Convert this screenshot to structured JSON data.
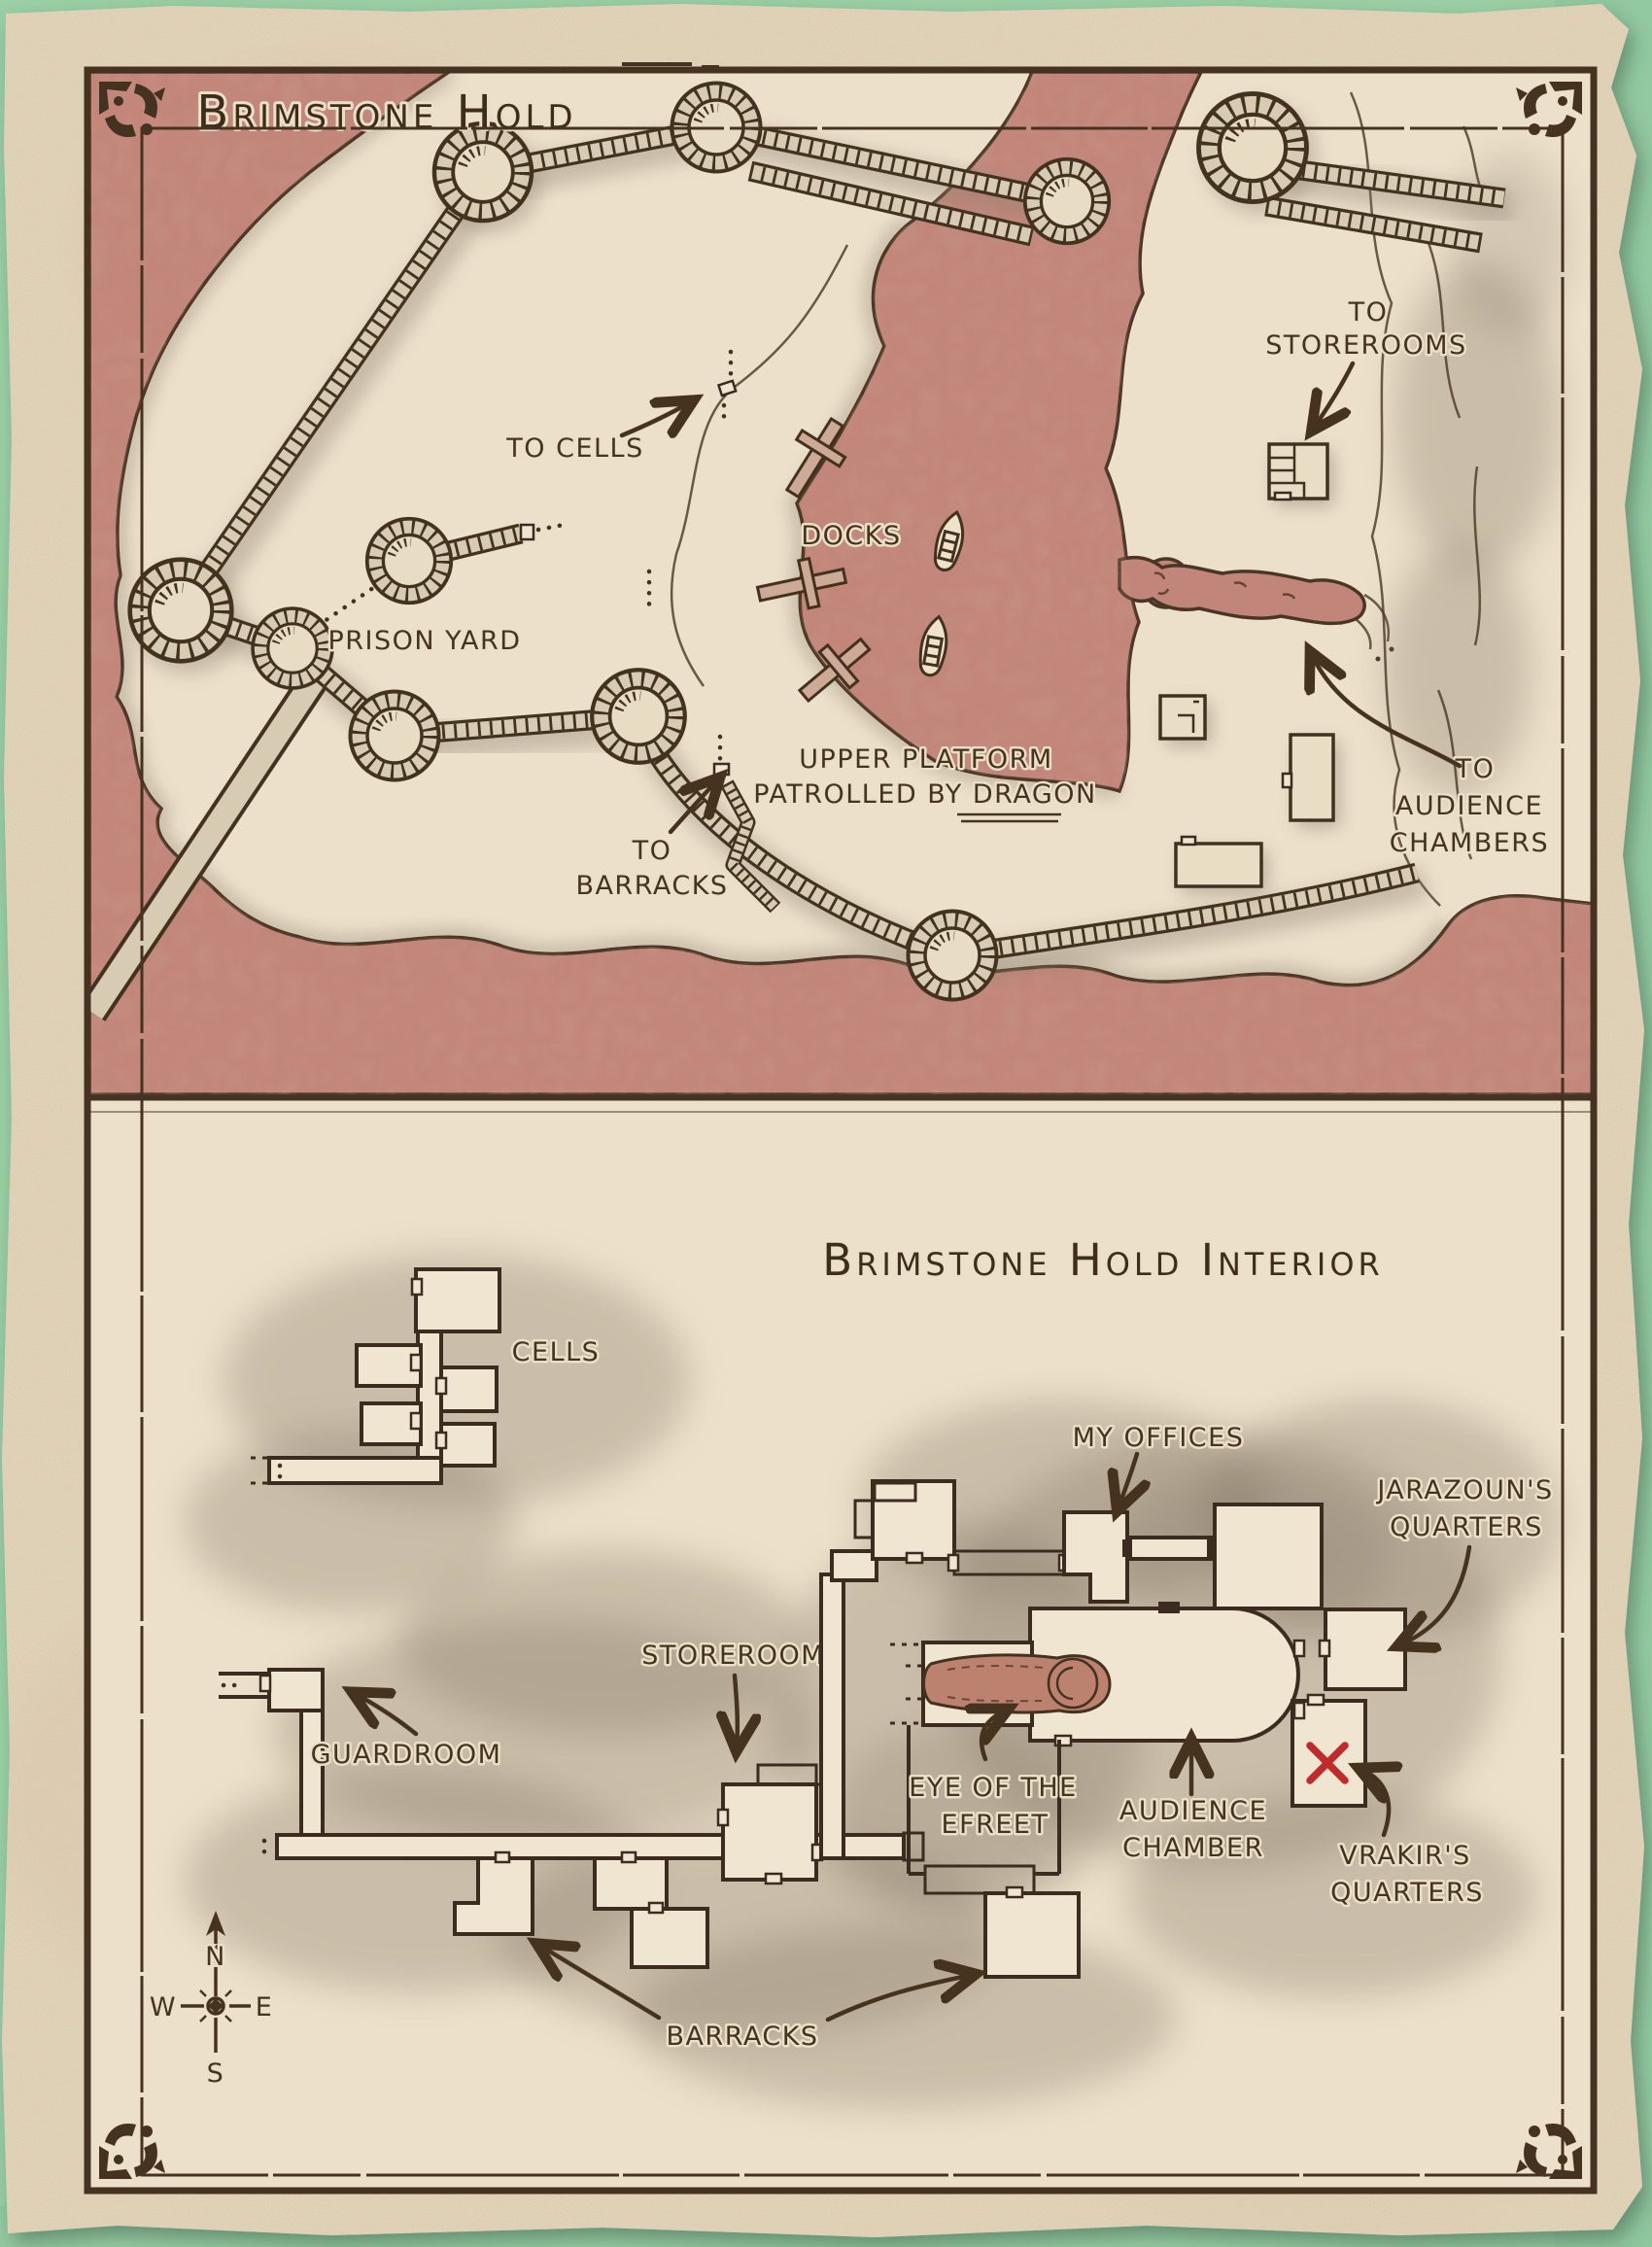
{
  "overview": {
    "title": "Brimstone Hold",
    "labels": {
      "to_storerooms_1": "TO",
      "to_storerooms_2": "STOREROOMS",
      "to_cells": "TO CELLS",
      "docks": "DOCKS",
      "prison_yard": "PRISON YARD",
      "upper_platform_1": "UPPER PLATFORM",
      "upper_platform_2a": "PATROLLED BY ",
      "upper_platform_dragon": "DRAGON",
      "to_barracks_1": "TO",
      "to_barracks_2": "BARRACKS",
      "to_audience_1": "TO",
      "to_audience_2": "AUDIENCE",
      "to_audience_3": "CHAMBERS"
    }
  },
  "interior": {
    "title": "Brimstone Hold Interior",
    "labels": {
      "cells": "CELLS",
      "my_offices": "MY OFFICES",
      "jarazoun_1": "JARAZOUN'S",
      "jarazoun_2": "QUARTERS",
      "storerooms": "STOREROOMS",
      "guardroom": "GUARDROOM",
      "eye_1": "EYE OF THE",
      "eye_2": "EFREET",
      "audience_1": "AUDIENCE",
      "audience_2": "CHAMBER",
      "vrakir_1": "VRAKIR'S",
      "vrakir_2": "QUARTERS",
      "barracks": "BARRACKS"
    },
    "marker_x_color": "#c02a2a"
  },
  "compass": {
    "north": "N",
    "south": "S",
    "east": "E",
    "west": "W"
  },
  "colors": {
    "background_green": "#9bcfa6",
    "parchment": "#e9dbc1",
    "ink": "#46331f",
    "lava": "#c28579",
    "grey_wash": "#877a67",
    "marker_red": "#c02a2a"
  }
}
